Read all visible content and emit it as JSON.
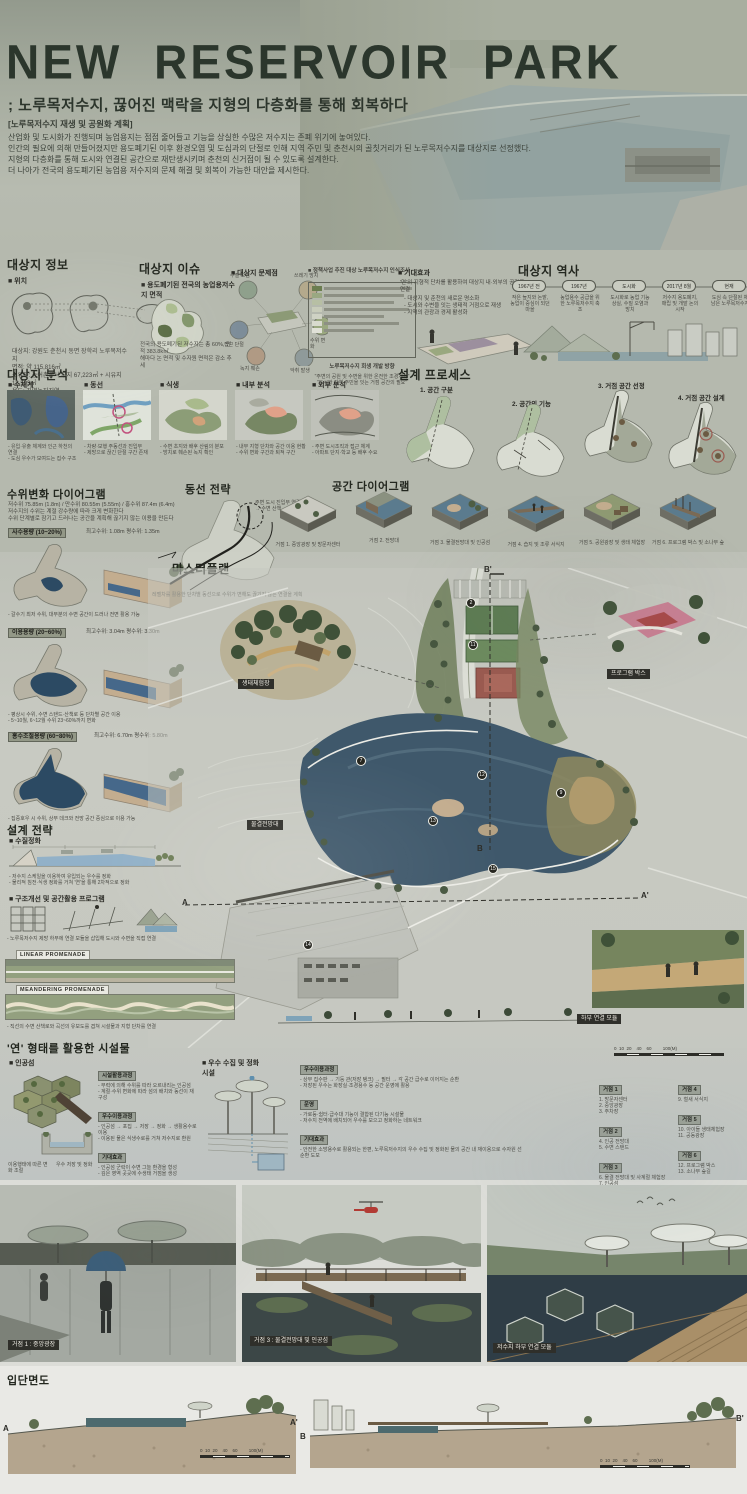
{
  "header": {
    "title": "NEW RESERVOIR PARK",
    "subtitle": "; 노루목저수지, 끊어진 맥락을 지형의 다층화를 통해 회복하다",
    "tag": "[노루목저수지 재생 및 공원화 계획]",
    "intro": "산업화 및 도시화가 진행되며 농업용지는 점점 줄어들고 기능을 상실한 수많은 저수지는 존폐 위기에 놓여있다.\n인간의 필요에 의해 만들어졌지만 용도폐기된 이후 환경오염 및 도심과의 단절로 인해 지역 주민 및 춘천시의 골칫거리가 된 노루목저수지를 대상지로 선정했다.\n지형의 다층화를 통해 도시와 연결된 공간으로 재탄생시키며 춘천의 신거점이 될 수 있도록 설계한다.\n더 나아가 전국의 용도폐기된 농업용 저수지의 문제 해결 및 회복이 가능한 대안을 제시한다."
  },
  "info": {
    "title": "대상지 정보",
    "loc": "■ 위치",
    "facts": "대상지: 강원도 춘천시 동면 장학리 노루목저수지\n면적: 약 115,816㎡\n소유자: 농어촌공사 부지 67,223㎡ + 시유지 18,593㎡\n용도: 자연녹지지역"
  },
  "issue": {
    "title": "대상지 이슈",
    "map_h": "■ 용도폐기된 전국의 농업용저수지 면적",
    "map_note": "전국의 용도폐기된 저수지는 총 60%, 면적 383.8k㎡\n해마다 논 면적 및 수자원 면적은 감소 추세",
    "prob_h": "■ 대상지 문제점",
    "problems": [
      "수질 오염",
      "쓰레기 방치",
      "접근 단절",
      "수위 변화",
      "녹지 훼손",
      "악취 발생"
    ],
    "survey_h": "■ 정책사업 추진 대상 노루목저수지 인식조사",
    "survey_note": "노루목저수지 회생 개발 방향",
    "survey_quote": "\"주변의 공원 및 수변을 위한 온전한 조경계획\"\n\"도시와 지역 주민을 잇는 거점 공간의 필요\"",
    "effect_h": "■ 기대효과",
    "effect_lead": "'연'의 지형적 단차를 활용하여 대상지 내·외부의 공간을 연결",
    "effect_note": "- 대상지 및 춘천의 새로운 명소화\n- 도시와 수변을 잇는 생태적 거점으로 재생\n- 지역의 관광과 경제 활성화"
  },
  "history": {
    "title": "대상지 역사",
    "t": [
      {
        "label": "1967년 전",
        "desc": "작은 늪지와 논밭, 농업이 중심이 되던 마을"
      },
      {
        "label": "1967년",
        "desc": "농업용수 공급을 위한 노루목저수지 축조"
      },
      {
        "label": "도시화",
        "desc": "도시화로 농업 기능 상실, 수질 오염과 방치"
      },
      {
        "label": "2017년 8월",
        "desc": "저수지 용도폐지, 매립 및 개발 논의 시작"
      },
      {
        "label": "현재",
        "desc": "도심 속 단절된 채 남은 노루목저수지"
      }
    ]
  },
  "analysis": {
    "title": "대상지 분석",
    "maps": [
      {
        "label": "■ 수체계",
        "note": "- 유입·유출 체계와 인근 하천의 연결\n- 도심 우수가 모여드는 집수 구조"
      },
      {
        "label": "■ 동선",
        "note": "- 차량·보행 주동선과 진입부\n- 제방으로 끊긴 단절 구간 존재"
      },
      {
        "label": "■ 식생",
        "note": "- 수변 초지와 배후 산림의 분포\n- 방치로 훼손된 녹지 확인"
      },
      {
        "label": "■ 내부 분석",
        "note": "- 내부 지형 단차와 공간 이용 현황\n- 수위 변화 구간과 퇴적 구간"
      },
      {
        "label": "■ 외부 분석",
        "note": "- 주변 도시조직과 접근 체계\n- 아파트 단지·학교 등 배후 수요"
      }
    ]
  },
  "process": {
    "title": "설계 프로세스",
    "steps": [
      "1. 공간 구분",
      "2. 공간의 기능",
      "3. 거점 공간 선정",
      "4. 거점 공간 설계"
    ]
  },
  "water": {
    "title": "수위변화 다이어그램",
    "intro": "저수위 75.85m (1.8m) / 만수위 80.55m (5.55m) / 홍수위 87.4m (6.4m)\n저수지의 수위는 계절 강수량에 따라 크게 변화한다\n수위 단계별로 잠기고 드러나는 공간을 계획해 끊기지 않는 이용을 만든다",
    "blocks": [
      {
        "tag": "사수용량 (10~20%)",
        "stat": "최고수위: 1.08m    평수위: 1.35m",
        "note": "- 갈수기 최저 수위, 대부분의 수변 공간이 드러나 전면 활용 가능"
      },
      {
        "tag": "이용용량 (20~60%)",
        "stat": "최고수위: 3.04m    평수위: 3.30m",
        "note": "- 평상시 수위, 수변 스탠드·산책로 등 단차별 공간 이용\n- 5~10월, 6~12월 수위 23~60%까지 변화"
      },
      {
        "tag": "홍수조절용량 (60~80%)",
        "stat": "최고수위: 6.70m    평수위: 5.80m",
        "note": "- 집중호우 시 수위, 상부 데크와 전망 공간 중심으로 이용 가능"
      }
    ]
  },
  "circul": {
    "title": "동선 전략",
    "note1": "주변 도시 진입부 연결\n→ 수변 산책",
    "note2": "레벨차를 활용한 단차별 동선으로 수위가 변해도 끊기지 않는 연결을 계획"
  },
  "space": {
    "title": "공간 다이어그램",
    "items": [
      "거점 1. 중앙광장 및 방문자센터",
      "거점 2. 전망대",
      "거점 3. 물결전망대 및 인공섬",
      "거점 4. 습지 및 조류 서식지",
      "거점 5. 공원광장 및 생태 체험장",
      "거점 6. 프로그램 박스 및 소나무 숲"
    ]
  },
  "plan": {
    "title": "마스터플랜",
    "scale": "0  10  20    40    60         100(M)",
    "a": "A",
    "a2": "A'",
    "b": "B",
    "b2": "B'",
    "chips": [
      "생태체험장",
      "프로그램 박스",
      "물결전망대",
      "하부 연결 모듈"
    ],
    "markers": [
      "2",
      "7",
      "9",
      "11",
      "12",
      "13",
      "14",
      "15"
    ]
  },
  "strategy": {
    "title": "설계 전략",
    "s1": "■ 수질정화",
    "s1_note": "- 저수지 스케일을 이용하여 유입되는 우수를 정화\n- 물리적 침전·식생 정화를 거쳐 '연'을 통해 2차적으로 정화",
    "s2": "■ 구조개선 및 공간활용 프로그램",
    "s2_note": "- 노루목저수지 제방 하부에 연결 모듈을 삽입해 도시와 수변을 직접 연결",
    "p1": "LINEAR PROMENADE",
    "p2": "MEANDERING PROMENADE",
    "p_note": "- 직선의 수변 산책로와 곡선의 유보도를 겹쳐 시설물과 지형 단차를 연결"
  },
  "lotus": {
    "title": "'연' 형태를 활용한 시설물",
    "island_h": "■ 인공섬",
    "cap1": "이용행태에 따른 변화 조절",
    "cap2": "우수 저장 및 정화",
    "b1_tag": "시설활용과정",
    "b1": "- 부력에 의해 수위를 따라 오르내리는 인공섬\n- 계절·수위 변화에 따라 섬의 배치와 동선이 재구성",
    "b2_tag": "우수이용과정",
    "b2": "- 인공섬 → 포집 → 저장 → 정화 → 생활용수로 이용\n- 이용된 물은 식생수로를 거쳐 저수지로 환원",
    "b3_tag": "기대효과",
    "b3": "- 인공섬 군락이 수변 그늘 환경을 형성\n- 깊은 영역 곳곳에 수생태 거점을 생성",
    "b4_tag": "목표",
    "b4": "저수지의 재소생"
  },
  "rain": {
    "h": "■ 우수 수집 및 정화 시설",
    "b1_tag": "우수이용과정",
    "b1": "- 상부 집수판 → 기둥 관(저장 탱크) → 필터 → 각 공간 급수로 이어지는 순환\n- 저장된 우수는 화장실·조경용수 등 공간 운영에 활용",
    "b2_tag": "운영",
    "b2": "- 가로등·쉼터·급수대 기능이 결합된 다기능 시설물\n- 저수지 전역에 배치되어 우수를 모으고 정화하는 네트워크",
    "b3_tag": "기대효과",
    "b3": "- 안전한 소방용수로 활용되는 한편, 노루목저수지의 우수 수집 및 정화된 물의 공간 내 재이용으로 수자원 선순환 도모"
  },
  "legend": {
    "g": [
      {
        "tag": "거점 1",
        "items": "1. 방문자센터\n2. 중앙광장\n3. 주차장"
      },
      {
        "tag": "거점 2",
        "items": "4. 인공 전망대\n5. 수변 스탠드"
      },
      {
        "tag": "거점 3",
        "items": "6. 물결 전망대 및 사계절 체험장\n7. 인공섬\n8. 습지"
      },
      {
        "tag": "거점 4",
        "items": "9. 철새 서식지"
      },
      {
        "tag": "거점 5",
        "items": "10. 아이들 생태체험장\n11. 공동광장"
      },
      {
        "tag": "거점 6",
        "items": "12. 프로그램 박스\n13. 소나무 숲길"
      },
      {
        "tag": "저수지 하부 공간",
        "items": "14. 연결 모듈\n15. 하부 산책로"
      }
    ]
  },
  "renders": {
    "c1": "거점 1 : 중앙광장",
    "c2": "거점 3 : 물결전망대 및 인공섬",
    "c3": "저수지 하부 연결 모듈"
  },
  "sections": {
    "title": "입단면도",
    "a": "A",
    "a2": "A'",
    "b": "B",
    "b2": "B'",
    "scale1": "0  10  20    40    60         100(M)",
    "scale2": "0  10  20    40    60         100(M)"
  }
}
